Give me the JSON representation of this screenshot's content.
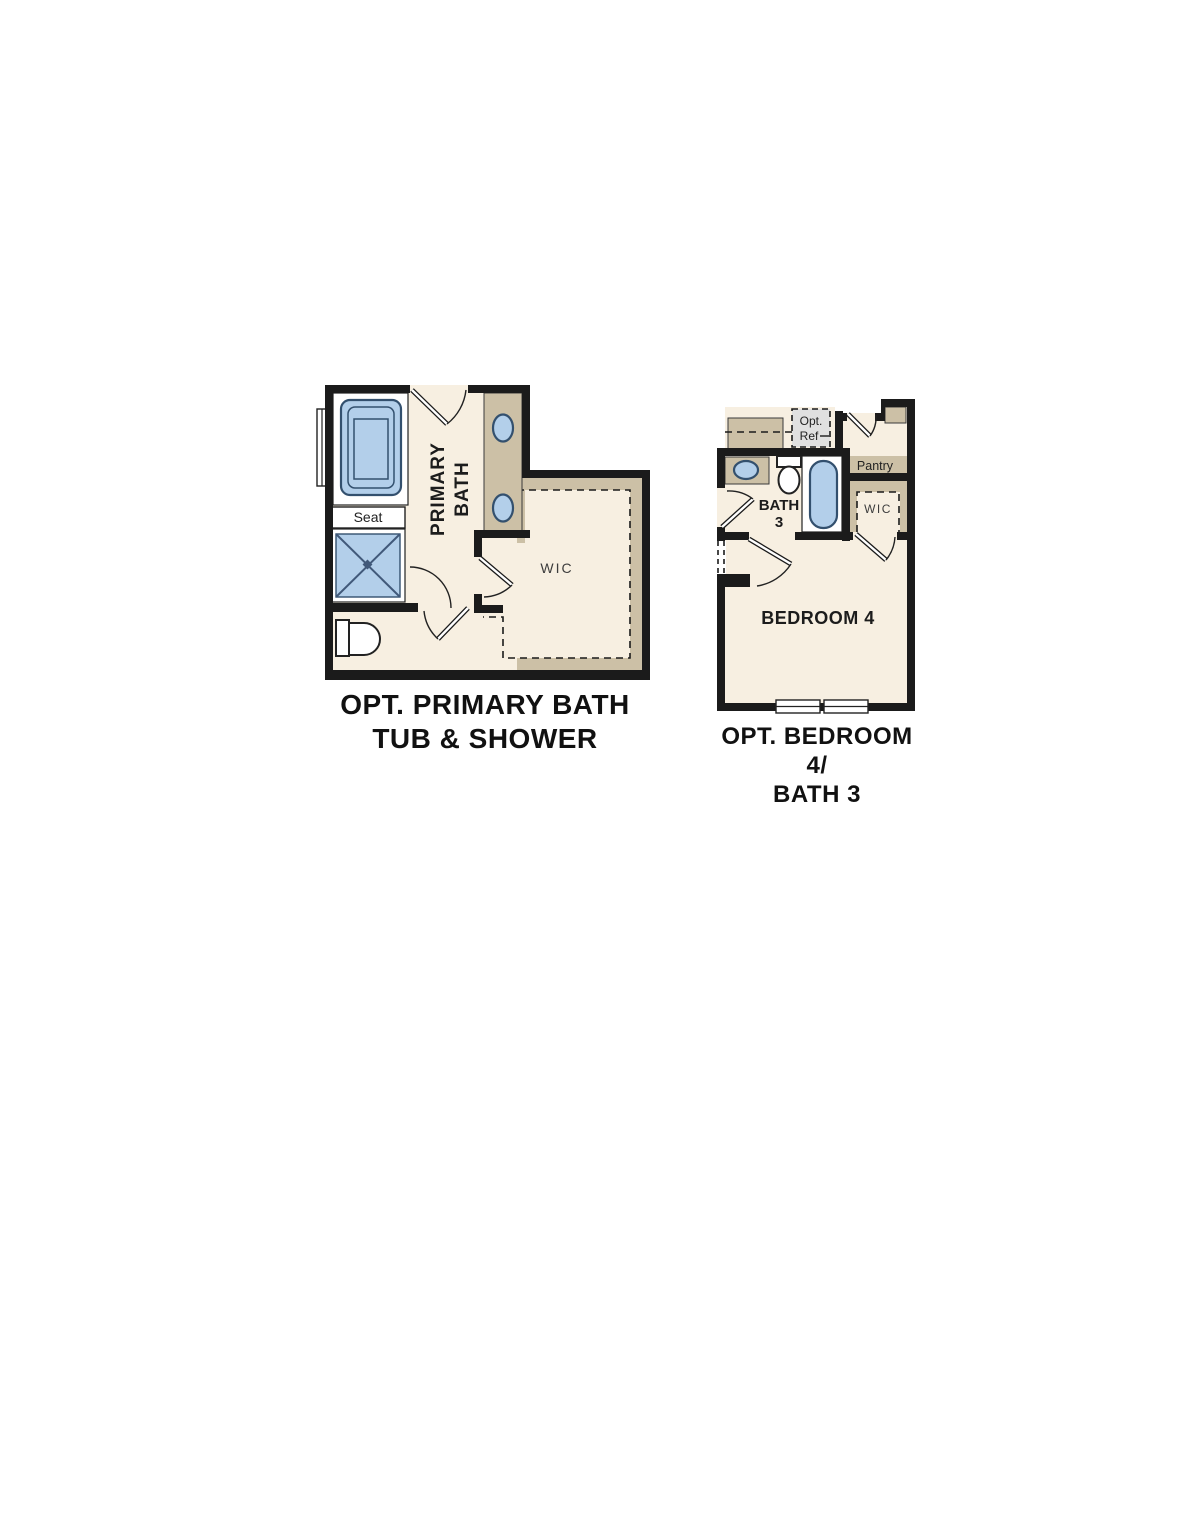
{
  "document": {
    "background": "#ffffff",
    "type": "floor-plan-options"
  },
  "colors": {
    "wall": "#1b1b1b",
    "floor": "#f7efe1",
    "cabinet_tan": "#ccc0a6",
    "fixture_blue": "#b3cfea",
    "fixture_outline": "#33506e",
    "optional_gray": "#e0e0e0",
    "label_gray": "#3d3d3d",
    "text": "#111111"
  },
  "plans": [
    {
      "id": "opt-primary-bath",
      "title_lines": [
        "OPT. PRIMARY BATH",
        "TUB & SHOWER"
      ],
      "labels": {
        "room_line1": "PRIMARY",
        "room_line2": "BATH",
        "seat": "Seat",
        "wic": "WIC"
      },
      "fixtures": [
        "garden-tub",
        "shower-with-seat",
        "toilet",
        "double-sink-vanity",
        "window",
        "walk-in-closet-shelving",
        "door-swings"
      ]
    },
    {
      "id": "opt-bedroom4-bath3",
      "title_lines": [
        "OPT. BEDROOM 4/",
        "BATH 3"
      ],
      "labels": {
        "opt_ref_line1": "Opt.",
        "opt_ref_line2": "Ref",
        "pantry": "Pantry",
        "bath_line1": "BATH",
        "bath_line2": "3",
        "wic": "WIC",
        "bedroom": "BEDROOM 4"
      },
      "fixtures": [
        "optional-refrigerator",
        "counter",
        "pantry-shelf",
        "sink-vanity",
        "toilet",
        "tub",
        "walk-in-closet-shelving",
        "windows",
        "door-swings",
        "optional-opening"
      ]
    }
  ]
}
